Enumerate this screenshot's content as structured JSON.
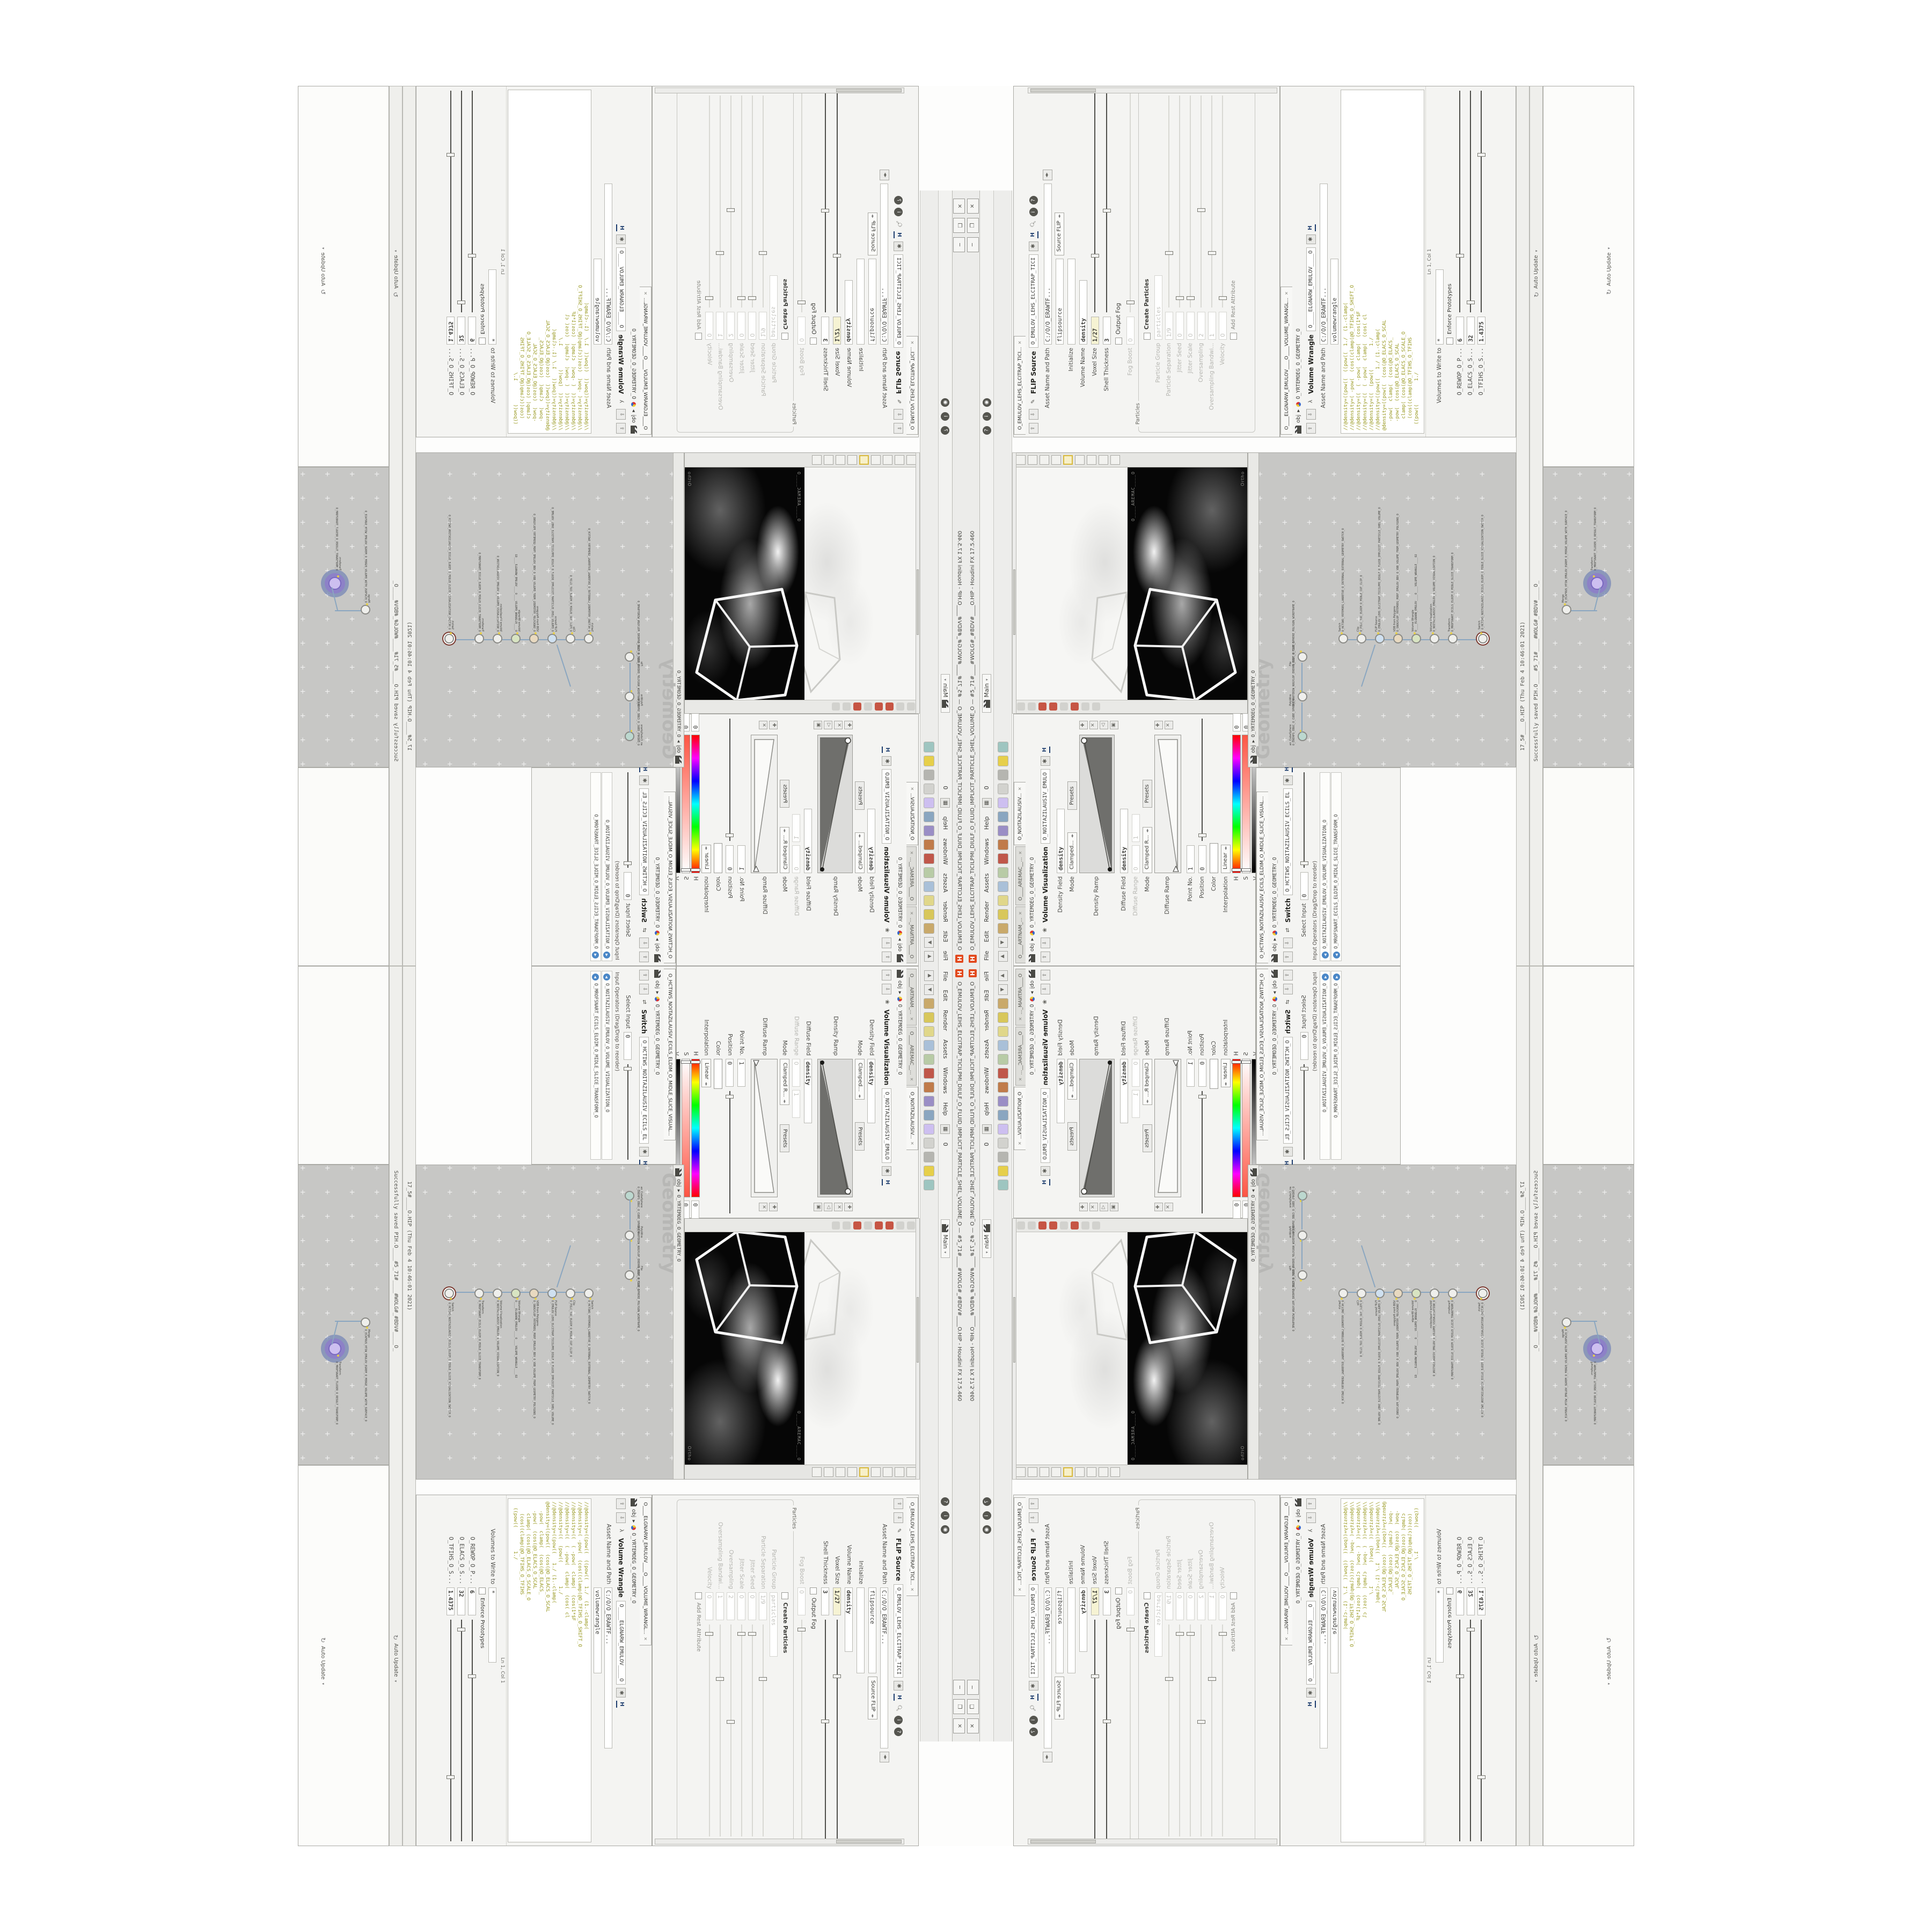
{
  "app": {
    "title": "O_EMULOV_LEHS_ELCITRAP_TICILPMI_DIULF_O_FLUID_IMPLICIT_PARTICLE_SHEL_VOLUME_O — #5_71#____#WOLG#_#BDV#____O.HIP - Houdini FX 17.5.460",
    "menu": [
      "File",
      "Edit",
      "Render",
      "Assets",
      "Windows",
      "Help"
    ],
    "desktop_label": "Main",
    "obj": "obj",
    "geometry_path": "O_YRTEMOEG_O_GEOMETRY_O",
    "network_watermark": "Geometry",
    "bar_saved": "17_5#____O.HIP (Thu Feb  4 10:46:01 2021)",
    "bar_status": "Successfully saved PIH.O____#5_71#____#WOLG#_#BDV#____O_",
    "auto_update": "Auto Update"
  },
  "tabs": {
    "mantra": "O____ARTNAM_...",
    "camera": "O____AREMAC__...",
    "visualization": "O_NOITAZILAUSIV...",
    "flip": "O_EMULOV_LEHS_ELCITRAP_TICI...",
    "wrangle": "O____ELGNARW_EMULOV____O____VOLUME_WRANGL...",
    "switch": "O_HCTIWS_NOITAZILAUSIV_ECILS_ELDIM_O_MIDLE_SLICE_VISUAL..."
  },
  "vis": {
    "title": "Volume Visualization",
    "name": "O_NOITAZILAUSIV_EMULO",
    "density_field_label": "Density Field",
    "density_field": "density",
    "mode_label": "Mode",
    "mode": "Clamped...",
    "presets": "Presets",
    "density_ramp_label": "Density Ramp",
    "diffuse_field_label": "Diffuse Field",
    "diffuse_field": "density",
    "diffuse_range_label": "Diffuse Range",
    "diffuse_range_min": "0",
    "diffuse_range_max": "1",
    "mode2_label": "Mode",
    "mode2": "Clamped R...",
    "diffuse_ramp_label": "Diffuse Ramp",
    "point_no_label": "Point No.",
    "point_no": "1",
    "position_label": "Position",
    "position": "0",
    "color_label": "Color",
    "interp_label": "Interpolation",
    "interp": "Linear",
    "h_label": "H",
    "h": "0",
    "s_label": "S",
    "s": "0",
    "v_label": "V",
    "v": "1.8125"
  },
  "switchpane": {
    "title": "Switch",
    "name": "O_HCTIWS_NOITAZILAUSIV_ECILS_EL",
    "select_input_label": "Select Input",
    "select_input": "0",
    "input_ops_label": "Input Operators (Drag/Drop to reorder)",
    "items": [
      "O_NOITAZILAUSIV_EMULOV_O_VOLUME_VISUALIZATION_O",
      "O_MROFSNART_ECILS_ELDIM_O_MIDLE_SLICE_TRANSFORM_O"
    ]
  },
  "flip": {
    "title": "FLIP Source",
    "name": "O_EMULOV_LEHS_ELCITRAP_TICI",
    "asset_label": "Asset Name and Path",
    "asset_path": "C:/O/O_ERAWTF...",
    "node_name": "flipsource",
    "source_type": "Source FLIP",
    "rows": [
      {
        "label": "Initialize",
        "value": ""
      },
      {
        "label": "Volume Name",
        "value": "density"
      },
      {
        "label": "Voxel Size",
        "value": "1/27"
      },
      {
        "label": "Shell Thickness",
        "value": "3"
      },
      {
        "label": "Output Fog",
        "value": ""
      },
      {
        "label": "Fog Boost",
        "value": "0"
      }
    ],
    "particles_label": "Particles",
    "create_particles": "Create Particles",
    "prows": [
      {
        "label": "Particle Group",
        "value": "particles"
      },
      {
        "label": "Particle Separation",
        "value": "1/9"
      },
      {
        "label": "Jitter Seed",
        "value": "0"
      },
      {
        "label": "Jitter Scale",
        "value": "0"
      },
      {
        "label": "Oversampling",
        "value": "2"
      },
      {
        "label": "Oversampling Bandwi...",
        "value": "1"
      },
      {
        "label": "Velocity",
        "value": "0"
      }
    ],
    "add_rest": "Add Rest Attribute"
  },
  "wrangle": {
    "title": "Volume Wrangle",
    "name": "O____ELGNARW_EMULOV____O",
    "asset_label": "Asset Name and Path",
    "asset_path": "C:/O/O_ERAWTF...",
    "node_name": "volumewrangle",
    "code": [
      "//@density=((pow((  ((pow((  1./  (1.-clamp(",
      "//@density=( -pow(  (cos((clamp(@O_TFIHS_O_SHIFT_O",
      "//@density=((  ( -pow(  clamp(  (cos(1*$F",
      "//@density=((  ( -pow(  clamp(  (cos( cl",
      "//@density=((  (pow((        1./",
      "//@density=((pow((   1./ (1.-clamp(",
      "@density=((pow((  (cos(@O_ELACS_O_SCAL",
      "   -pow(  clamp(  (cos(@O_ELACS_",
      "   -pow(  (cos(@O_ELACS_O_SCAL",
      "    clamp( (cos(@O_ELACS_O_SCALE_O",
      "    (cos((clamp(@O_TFIHS_O_TFIHS",
      "  ((pow((        1./"
    ],
    "cursor": "Ln 1, Col 1",
    "volumes_label": "Volumes to Write to",
    "volumes": "*",
    "enforce": "Enforce Prototypes",
    "spares": [
      {
        "label": "O_REWOP_O_P...",
        "value": "6"
      },
      {
        "label": "O_ELACS_O_S...",
        "value": "32"
      },
      {
        "label": "O_TFIHS_O_S...",
        "value": "1.4375"
      }
    ]
  },
  "viewport": {
    "camera_label": "O____AREMAC____O",
    "ortho_label": "Ortho"
  },
  "net1": {
    "chainA": [
      {
        "type": "an_CubeSphere",
        "name": "O_EREHPS_EBUC_O_CUBE_SPHERE_O"
      },
      {
        "type": "PolyWire",
        "name": "O_EMARFERIW_NOGYLOP_EREHPS_EBUC_O_CUBE_SPHERE_POLYGON_WIREFRAME_O"
      },
      {
        "type": "File",
        "name": "O_ELIF_O_FILE_O"
      }
    ],
    "chainB": [
      {
        "type": "Switch",
        "name": "O_HCTIWS_YRTEMOEG_LANRETXE_O_INTERNAL_EXTERNAL_GEOMETRY_SWITCH_O"
      },
      {
        "type": "Clip",
        "name": "O_PILC_TUC_ELDIM_O_MIDLE_CUT_CLIP_O"
      },
      {
        "type": "FLIP Source",
        "name": "O_EMULOV_LEHS_ELCITRAP_TICILPMI_DIULF_O_FLUID_IMPLICIT_PARTICLE_SHEL_VOLUME_O"
      },
      {
        "type": "VDB from Polygons",
        "name": "O_SNOGYLOP_YRTEMOEG_MORF_EMULOV_BDV_O_VDB_VOLUME_FROM_GEOMETRY_POLYGONS_O"
      },
      {
        "type": "Volume Wrangle",
        "name": "O____ELGNARW_EMULOV____O____VOLUME_WRANGLE____O2"
      },
      {
        "type": "Volume Visualization",
        "name": "O_NOITAZILAUSIV_EMULOV_O_VOLUME_VISUALIZATION_O"
      },
      {
        "type": "Transform",
        "name": "O_MROFSNART_ECILS_ELDIM_O_MIDLE_SLICE_TRANSFORM_O"
      },
      {
        "type": "Switch",
        "name": "O_HCTIWS_NOITAZILAUSIV_ECILS_ELDIM_O_MIDLE_SLICE_VISUALIZATION_SWITCH_O"
      }
    ]
  },
  "net2": {
    "chain": [
      {
        "type": "Merge",
        "name": "O_ECAFRUS_HTIW_EMULOV_EGREM_O_MERGE_VOLUME_WITH_SURFACE_O"
      },
      {
        "type": "Transform",
        "name": "O_MROFSNART_TLUSER_O_RESULT_TRANSFORM_O"
      }
    ]
  },
  "colors": {
    "accent_purple": "#8d7cc9",
    "node_ring_red": "#7a3a30",
    "flag_yellow": "#e6cf4a",
    "field_yellow": "#f6f3d3",
    "code_olive": "#97971d",
    "code_teal": "#2b9191",
    "network_bg": "#c7c7c5"
  }
}
